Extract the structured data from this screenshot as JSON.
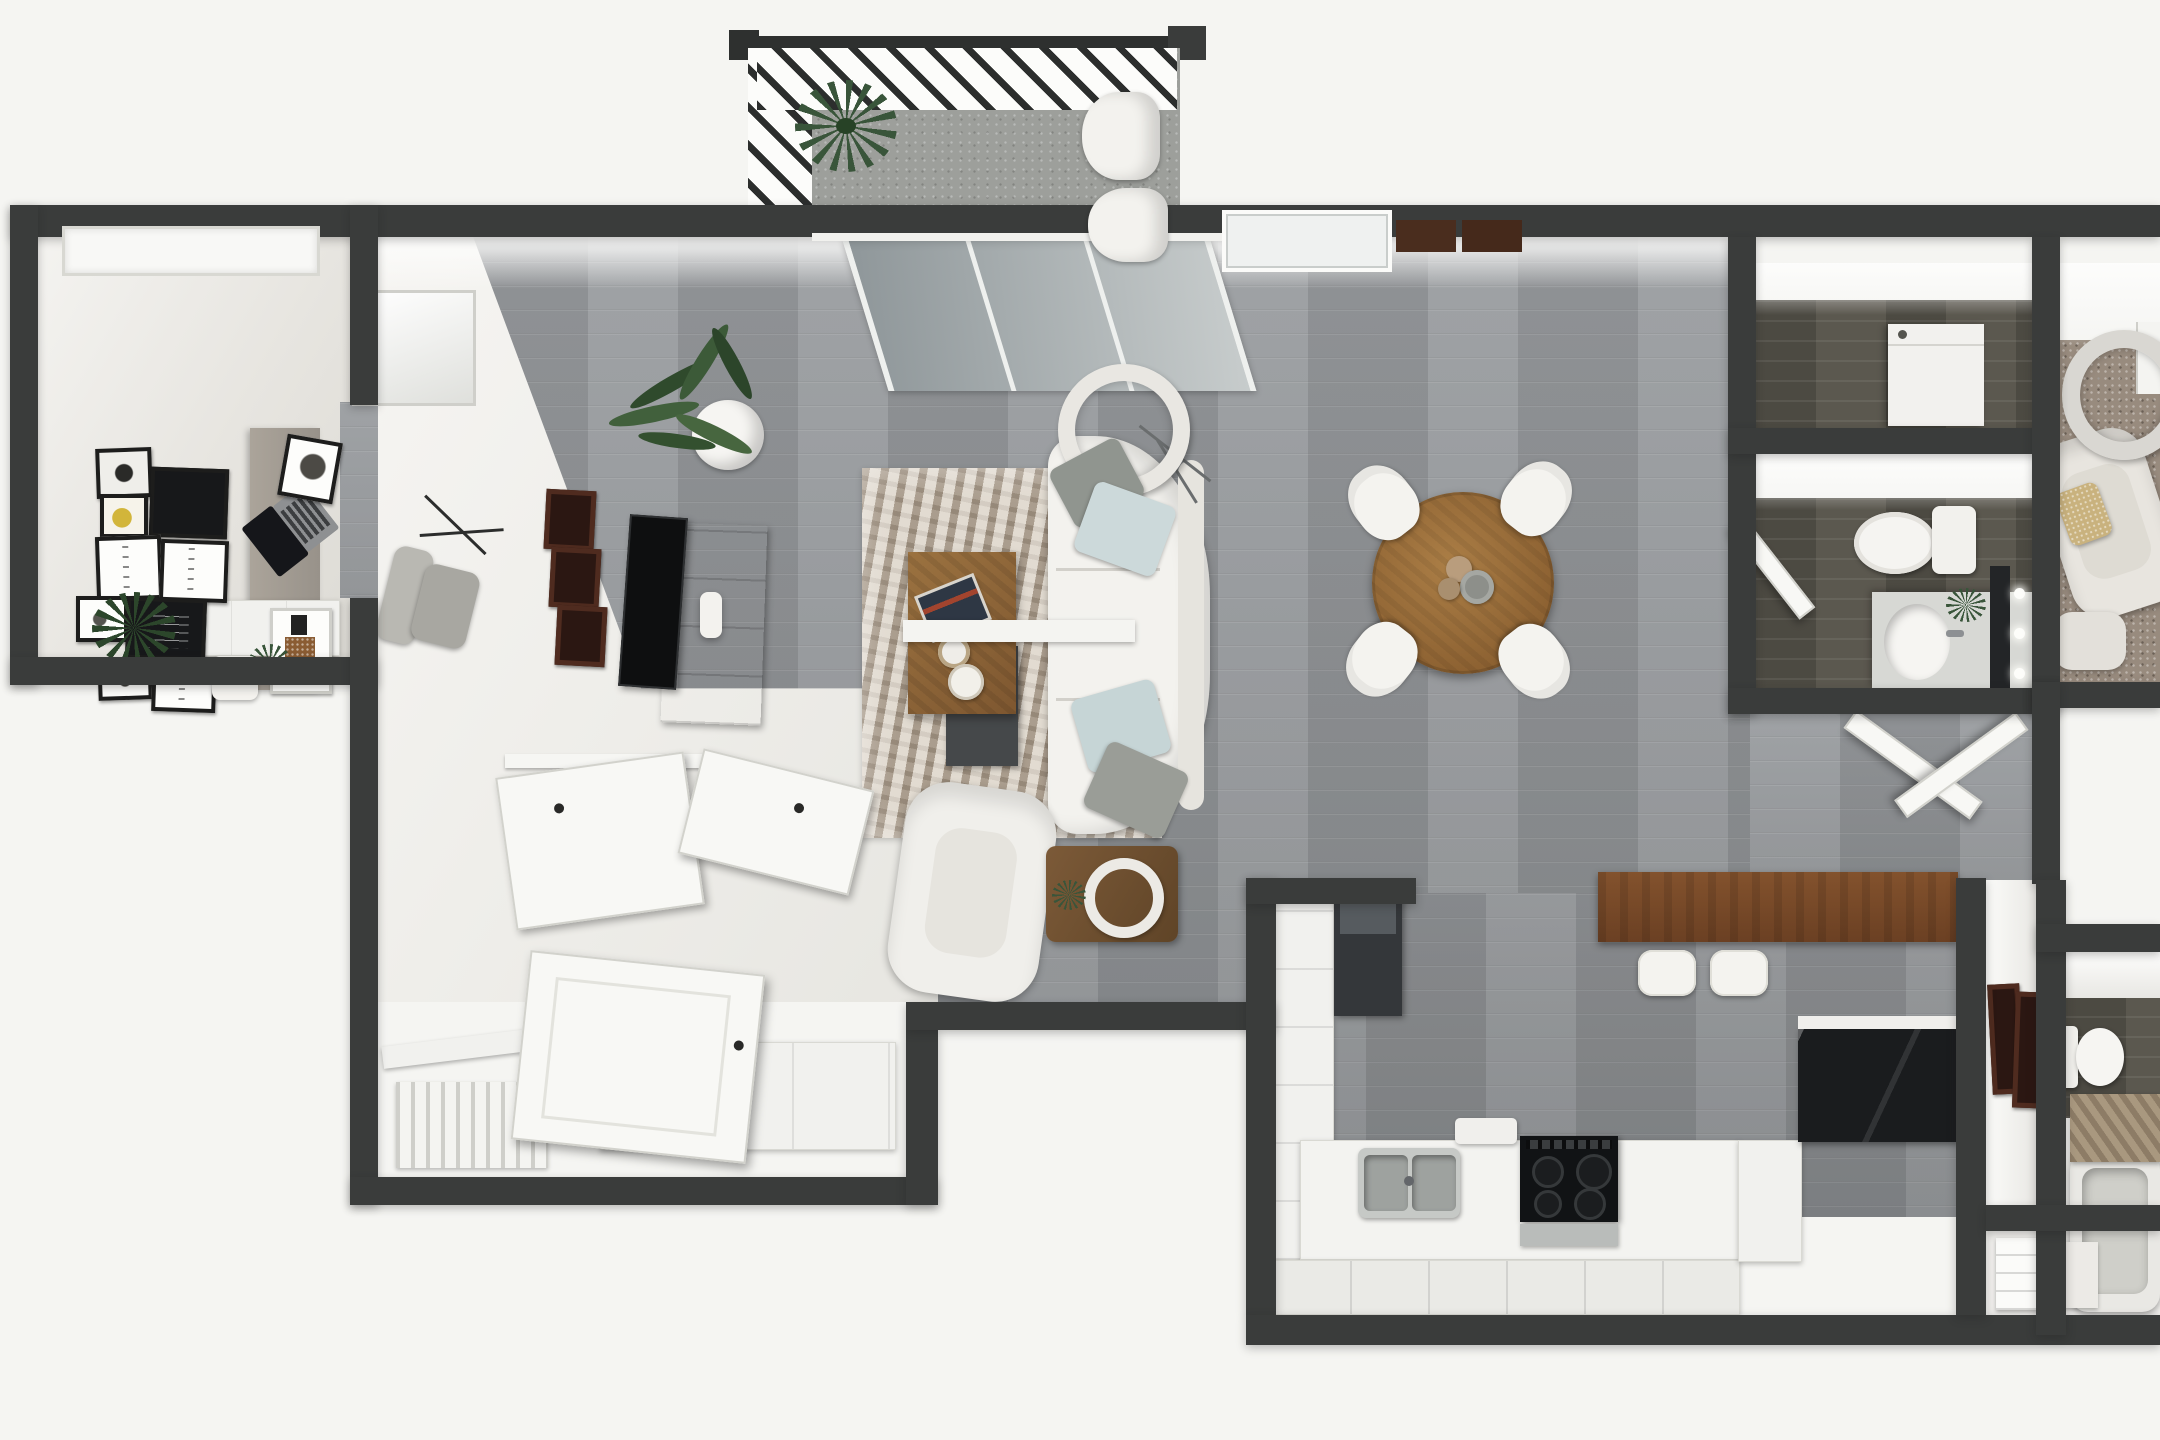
{
  "meta": {
    "description": "Top-down 3D rendered apartment floor plan, one-bedroom-plus-office layout with balcony",
    "view": "top-down axonometric render",
    "canvas": {
      "width": 2160,
      "height": 1440
    },
    "visible_text": []
  },
  "palette": {
    "background": "#f5f5f2",
    "walls": "#3a3c3b",
    "wood_floor": "#95989a",
    "dark_bath_floor": "#5b584f",
    "balcony_concrete": "#9d9f9b",
    "bedroom_carpet": "#988b7e",
    "white_furniture": "#f3f2ee",
    "accent_wood": "#8a6543",
    "breakfast_bar_wood": "#77492a",
    "dining_table_wood": "#9a7038",
    "black_counter": "#1a1c1e",
    "stove_black": "#111315",
    "pillow_gray": "#90958f",
    "pillow_blue": "#ccd9da",
    "plant_green": "#39553a",
    "maroon_frames": "#4f2b1f"
  },
  "rooms": [
    {
      "id": "balcony",
      "label": "Balcony",
      "floor": "concrete",
      "items": [
        "slatted trellis privacy walls",
        "corner spiky potted plant",
        "two white lounge chairs"
      ]
    },
    {
      "id": "office",
      "label": "Office / second room",
      "floor": "light + gray wood",
      "items": [
        "window",
        "gallery wall of nine black-framed prints",
        "desk with open laptop",
        "framed desk art",
        "desk lamp",
        "small potted plant",
        "gray office chair",
        "white dresser",
        "floor plant"
      ]
    },
    {
      "id": "living-room",
      "label": "Living room",
      "floor": "gray wood planks",
      "items": [
        "sliding glass balcony door",
        "snake plant in white pot",
        "three dark red wall frames",
        "flat TV on wood media console",
        "mottled area rug",
        "wood coffee table with books and two trays",
        "white sofa with gray and light blue pillows",
        "white armchair",
        "arc floor lamp with round shade",
        "round side table with bowl and plant"
      ]
    },
    {
      "id": "dining-area",
      "label": "Dining area",
      "floor": "gray wood planks",
      "items": [
        "round wood dining table",
        "four white chairs",
        "centerpiece dishes"
      ]
    },
    {
      "id": "kitchen",
      "label": "Kitchen",
      "floor": "gray wood planks",
      "items": [
        "tall dark pantry / refrigerator",
        "white cabinet run",
        "double stainless sink",
        "black four-burner cooktop",
        "white counter with drawers",
        "black stone counter",
        "wood breakfast bar",
        "two white bar stools"
      ]
    },
    {
      "id": "laundry-closet",
      "label": "Closet / laundry",
      "floor": "dark wood",
      "items": [
        "white appliance box"
      ]
    },
    {
      "id": "bathroom-1",
      "label": "Bathroom 1",
      "floor": "dark wood",
      "items": [
        "toilet",
        "vanity with oval sink",
        "mirror with three sconce lights",
        "small plant",
        "open door"
      ]
    },
    {
      "id": "bedroom-2",
      "label": "Bedroom (top right, cropped)",
      "floor": "beige carpet",
      "items": [
        "round pendant lamp",
        "cream accent chair with tan pillow",
        "ottoman",
        "window"
      ]
    },
    {
      "id": "hallway",
      "label": "Hallway",
      "floor": "gray wood planks",
      "items": [
        "pair of open white doors",
        "wall with two dark framed pictures"
      ]
    },
    {
      "id": "bathroom-2",
      "label": "Bathroom 2 (bottom right, cropped)",
      "floor": "dark wood",
      "items": [
        "toilet",
        "wood slat bath mat",
        "bathtub"
      ]
    },
    {
      "id": "entry-mudroom",
      "label": "Entry / closets",
      "floor": "white tile",
      "items": [
        "three open white doors",
        "closet cabinet row",
        "striped shoe shelf",
        "utility closet with dark appliance"
      ]
    },
    {
      "id": "linen-closet",
      "label": "Linen closet",
      "floor": "white",
      "items": [
        "white shelving steps"
      ]
    }
  ]
}
